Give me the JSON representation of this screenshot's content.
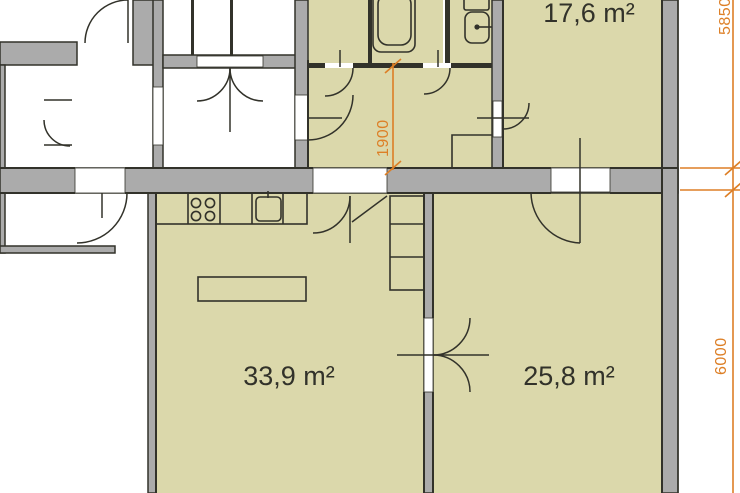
{
  "plan": {
    "title": "apartment-floor-plan",
    "rooms": [
      {
        "name": "room-top-right",
        "area_label": "17,6 m²"
      },
      {
        "name": "room-bottom-left",
        "area_label": "33,9 m²"
      },
      {
        "name": "room-bottom-right",
        "area_label": "25,8 m²"
      }
    ],
    "dimensions": {
      "right_top": "5850",
      "right_bottom": "6000",
      "hall_width": "1900"
    },
    "colors": {
      "room_fill": "#dbd8ab",
      "wall_fill": "#ababab",
      "outline": "#32322a",
      "dimension": "#dd7f26",
      "background": "#ffffff"
    }
  }
}
